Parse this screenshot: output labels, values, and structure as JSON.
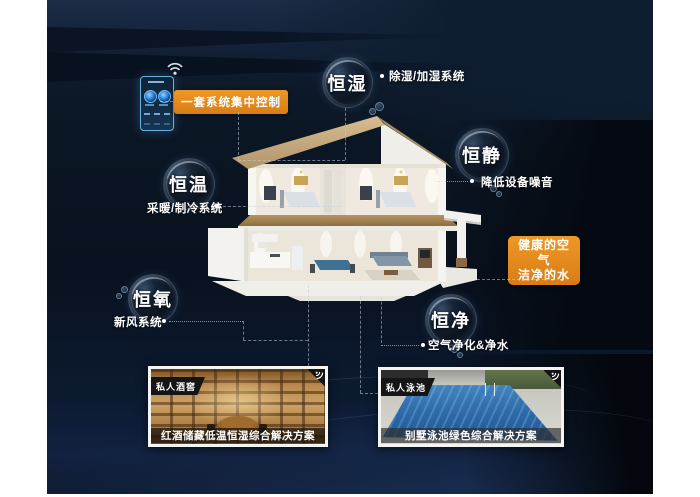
{
  "colors": {
    "accent_orange": "#E08620",
    "background_navy": "#0B1624",
    "card_badge_black": "#151515",
    "pool_blue": "#2E6CAB",
    "cellar_wood": "#CDA163"
  },
  "control": {
    "label": "一套系统集中控制"
  },
  "features": [
    {
      "bubble": "恒湿",
      "note": "除湿/加湿系统"
    },
    {
      "bubble": "恒静",
      "note": "降低设备噪音"
    },
    {
      "bubble": "恒温",
      "note": "采暖/制冷系统"
    },
    {
      "bubble": "恒氧",
      "note": "新风系统"
    },
    {
      "bubble": "恒净",
      "note": "空气净化&净水"
    }
  ],
  "highlight": {
    "line1": "健康的空气",
    "line2": "洁净的水"
  },
  "cards": [
    {
      "badge": "私人酒窖",
      "caption": "红酒储藏低温恒湿综合解决方案"
    },
    {
      "badge": "私人泳池",
      "caption": "别墅泳池绿色综合解决方案"
    }
  ],
  "icons": {
    "wifi": "wifi-icon",
    "control_panel": "smart-home-control-panel",
    "card_corner": "wifi-corner-icon"
  }
}
